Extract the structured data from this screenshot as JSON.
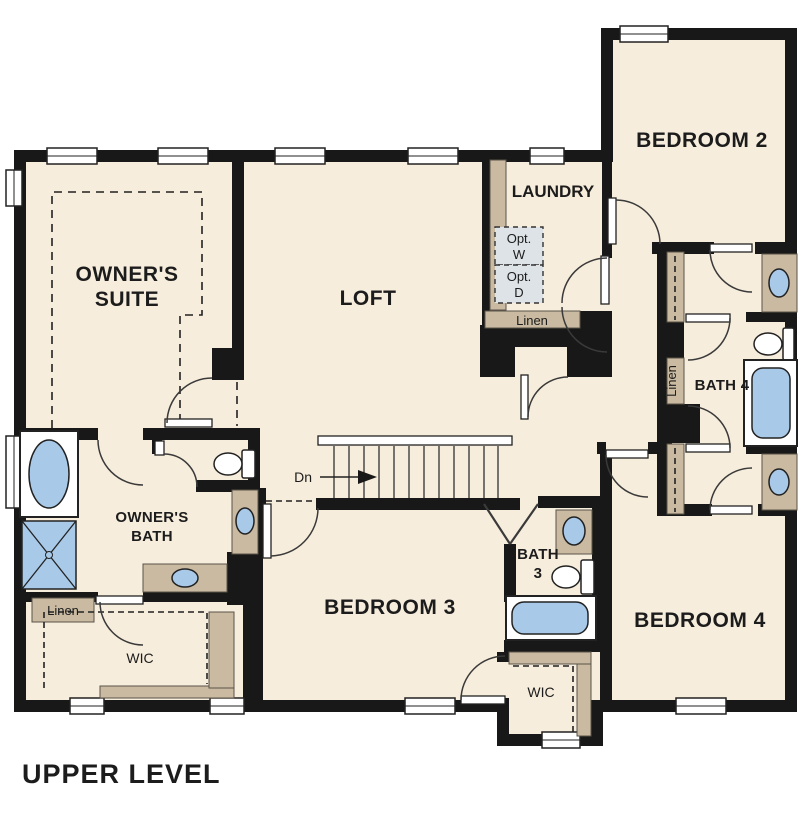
{
  "title": "UPPER LEVEL",
  "colors": {
    "background": "#ffffff",
    "room_fill": "#f7eddc",
    "wall": "#181818",
    "cabinetry_tan": "#c9baa1",
    "fixture_blue": "#a9c9e9",
    "optional_appliance_fill": "#dee3e7"
  },
  "labels": {
    "owners_suite_1": "OWNER'S",
    "owners_suite_2": "SUITE",
    "loft": "LOFT",
    "laundry": "LAUNDRY",
    "bedroom2": "BEDROOM 2",
    "opt_w_1": "Opt.",
    "opt_w_2": "W",
    "opt_d_1": "Opt.",
    "opt_d_2": "D",
    "linen_laundry": "Linen",
    "linen_hall": "Linen",
    "bath4": "BATH 4",
    "owners_bath_1": "OWNER'S",
    "owners_bath_2": "BATH",
    "linen_owners": "Linen",
    "wic_owners": "WIC",
    "dn": "Dn",
    "bedroom3": "BEDROOM 3",
    "bath3_1": "BATH",
    "bath3_2": "3",
    "bedroom4": "BEDROOM 4",
    "wic_hall": "WIC",
    "title": "UPPER LEVEL"
  }
}
